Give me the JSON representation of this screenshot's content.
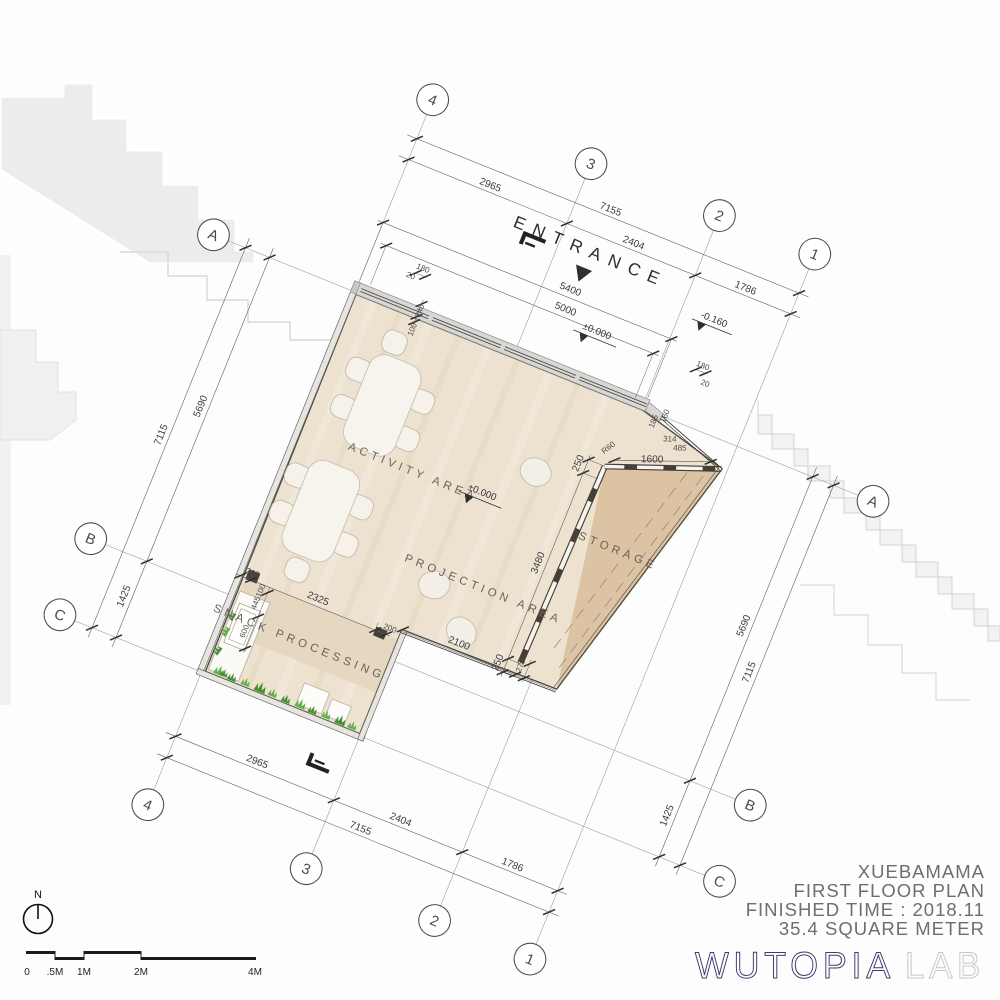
{
  "title_block": {
    "project": "XUEBAMAMA",
    "drawing": "FIRST FLOOR PLAN",
    "finished_time": "FINISHED TIME : 2018.11",
    "area": "35.4 SQUARE METER"
  },
  "logo": {
    "primary": "WUTOPIA",
    "secondary": "LAB",
    "primary_color": "#3c3c6e",
    "secondary_color": "#c6c6ca"
  },
  "north": {
    "label": "N"
  },
  "scale_bar": {
    "labels": [
      "0",
      ".5M",
      "1M",
      "2M",
      "4M"
    ]
  },
  "grid": {
    "numbered": [
      "4",
      "3",
      "2",
      "1"
    ],
    "lettered": [
      "A",
      "B",
      "C"
    ]
  },
  "rooms": {
    "entrance": "ENTRANCE",
    "activity": "ACTIVITY AREA",
    "projection": "PROJECTION AREA",
    "storage": "STORAGE",
    "snack": "SNACK PROCESSING"
  },
  "levels": {
    "zero_entry": "±0.000",
    "zero_hall": "±0.000",
    "minus": "-0.160"
  },
  "dimensions": {
    "top_total": "7155",
    "top_segments": [
      "2965",
      "2404",
      "1786"
    ],
    "bottom_total": "7155",
    "bottom_segments": [
      "2965",
      "2404",
      "1786"
    ],
    "left_total": "7115",
    "left_segments": [
      "5690",
      "1425"
    ],
    "right_total": "7115",
    "right_segments": [
      "5690",
      "1425"
    ],
    "entrance_outer": "5400",
    "entrance_inner": "5000",
    "small_left": [
      "180",
      "20",
      "240",
      "100"
    ],
    "small_right": [
      "180",
      "20",
      "160",
      "185",
      "314",
      "485"
    ],
    "storage_wall": "1600",
    "storage_radius": "R60",
    "right_wall": [
      "250",
      "3480",
      "250"
    ],
    "bottom_wall": [
      "2100",
      "270"
    ],
    "snack_top": [
      "200",
      "2325",
      "200"
    ],
    "snack_left": [
      "100",
      "445",
      "600"
    ]
  },
  "colors": {
    "floor": "#ece2cf",
    "storage_floor": "#dcc3a4",
    "snack_band": "#e4d5bd",
    "wall_line": "#4e4a43",
    "grass": "#62b04a",
    "entrance_band": "#d7d7d5"
  }
}
